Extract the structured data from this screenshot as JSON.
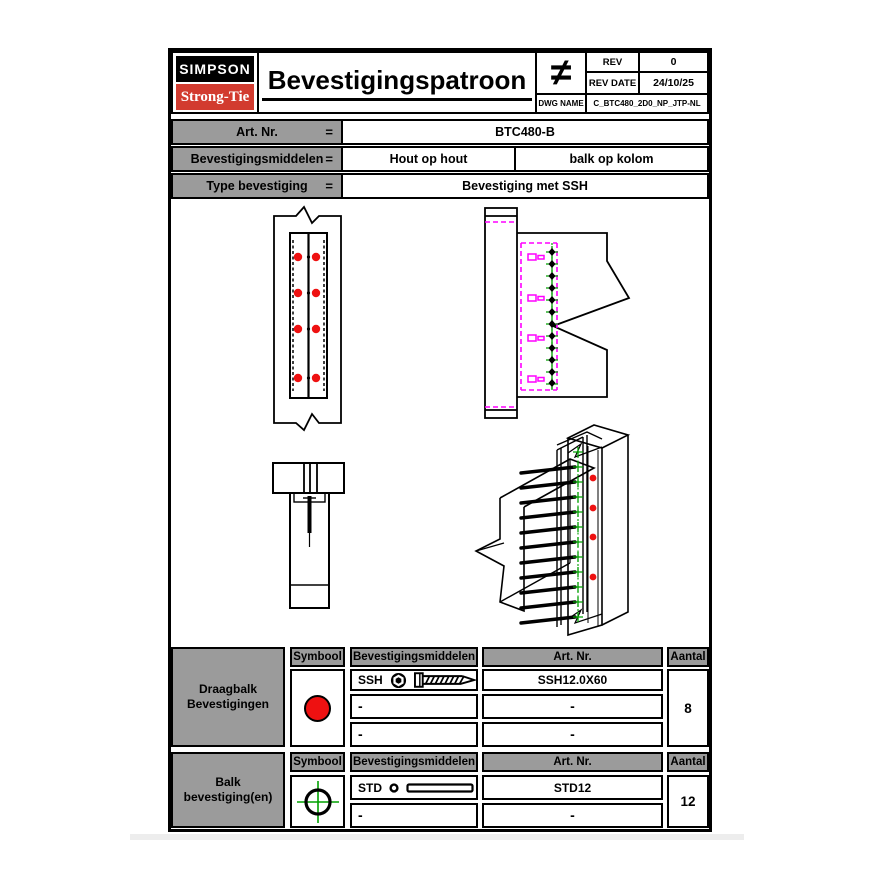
{
  "colors": {
    "red": "#ee1111",
    "magenta": "#ff00ff",
    "green": "#00a000",
    "gray": "#9b9b9b",
    "logo-red": "#d23b2f"
  },
  "header": {
    "logo_line1": "SIMPSON",
    "logo_line2": "Strong-Tie",
    "title": "Bevestigingspatroon",
    "symbol": "≠",
    "rev_label": "REV",
    "rev_value": "0",
    "rev_date_label": "REV DATE",
    "rev_date_value": "24/10/25",
    "dwg_label": "DWG NAME",
    "dwg_value": "C_BTC480_2D0_NP_JTP-NL"
  },
  "specs": {
    "rows": [
      {
        "label": "Art. Nr.",
        "eq": "=",
        "value": "BTC480-B"
      },
      {
        "label": "Bevestigingsmiddelen",
        "eq": "=",
        "value1": "Hout op hout",
        "value2": "balk op kolom"
      },
      {
        "label": "Type bevestiging",
        "eq": "=",
        "value": "Bevestiging met SSH"
      }
    ]
  },
  "drawings": {
    "front_view": {
      "red_dot_count": 8,
      "dot_color": "#ee1111"
    },
    "side_view": {
      "dowel_marker_count": 12,
      "hidden_line_color": "#ff00ff",
      "axis_color": "#00a000"
    },
    "isometric_view": {
      "red_dot_count": 4,
      "screw_rung_count": 11
    }
  },
  "fastener_tables": [
    {
      "group": [
        "Draagbalk",
        "Bevestigingen"
      ],
      "headers": [
        "Symbool",
        "Bevestigingsmiddelen",
        "Art. Nr.",
        "Aantal"
      ],
      "symbol_icon": "red-circle",
      "rows": [
        {
          "name": "SSH",
          "icon": "hex-nut-and-screw",
          "art": "SSH12.0X60"
        },
        {
          "name": "-",
          "icon": "",
          "art": "-"
        },
        {
          "name": "-",
          "icon": "",
          "art": "-"
        }
      ],
      "qty": "8"
    },
    {
      "group": [
        "Balk",
        "bevestiging(en)"
      ],
      "headers": [
        "Symbool",
        "Bevestigingsmiddelen",
        "Art. Nr.",
        "Aantal"
      ],
      "symbol_icon": "green-crosshair-circle",
      "rows": [
        {
          "name": "STD",
          "icon": "dowel",
          "art": "STD12"
        },
        {
          "name": "-",
          "icon": "",
          "art": "-"
        }
      ],
      "qty": "12"
    }
  ]
}
